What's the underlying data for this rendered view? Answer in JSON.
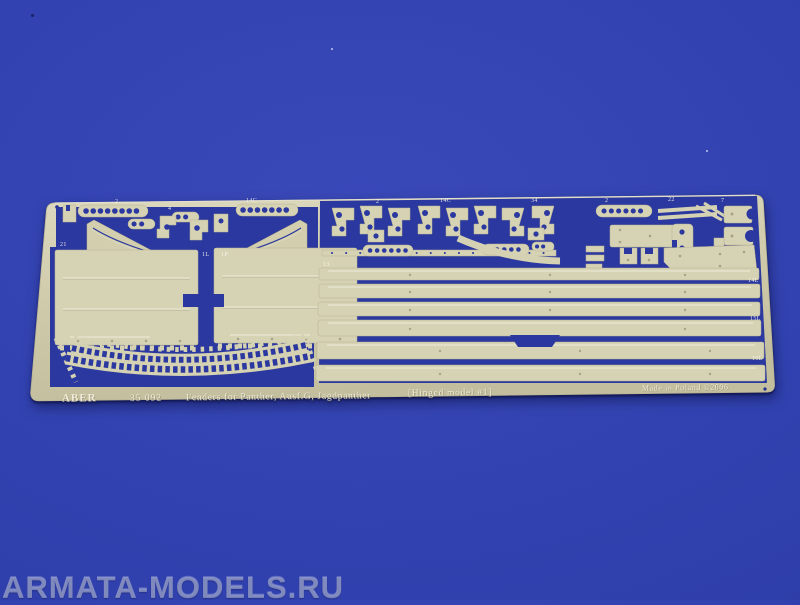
{
  "watermark": {
    "text": "ARMATA-MODELS.RU"
  },
  "fret": {
    "brand": "ABER",
    "product_number": "35 092",
    "title": "Fenders for Panther, Ausf.G, Jagdpanther",
    "title_note": "[Hinged model #1]",
    "made_in": "Made in Poland ©2006",
    "part_labels": [
      {
        "t": "2",
        "x": 95,
        "y": 13
      },
      {
        "t": "14C",
        "x": 226,
        "y": 12
      },
      {
        "t": "4",
        "x": 148,
        "y": 20
      },
      {
        "t": "2",
        "x": 356,
        "y": 13
      },
      {
        "t": "14C",
        "x": 420,
        "y": 12
      },
      {
        "t": "34",
        "x": 511,
        "y": 12
      },
      {
        "t": "2",
        "x": 585,
        "y": 12
      },
      {
        "t": "22",
        "x": 648,
        "y": 11
      },
      {
        "t": "7",
        "x": 701,
        "y": 12
      },
      {
        "t": "21",
        "x": 40,
        "y": 56
      },
      {
        "t": "1L",
        "x": 182,
        "y": 66
      },
      {
        "t": "1P",
        "x": 201,
        "y": 66
      },
      {
        "t": "13",
        "x": 303,
        "y": 76
      },
      {
        "t": "14L",
        "x": 728,
        "y": 92
      },
      {
        "t": "15L",
        "x": 730,
        "y": 130
      },
      {
        "t": "16L",
        "x": 732,
        "y": 170
      }
    ]
  },
  "colors": {
    "background_blue": "#3142b0",
    "brass_sheet": "#d2ceae",
    "cutout_blue": "#2b389f",
    "watermark_gray": "#b6bedb"
  }
}
